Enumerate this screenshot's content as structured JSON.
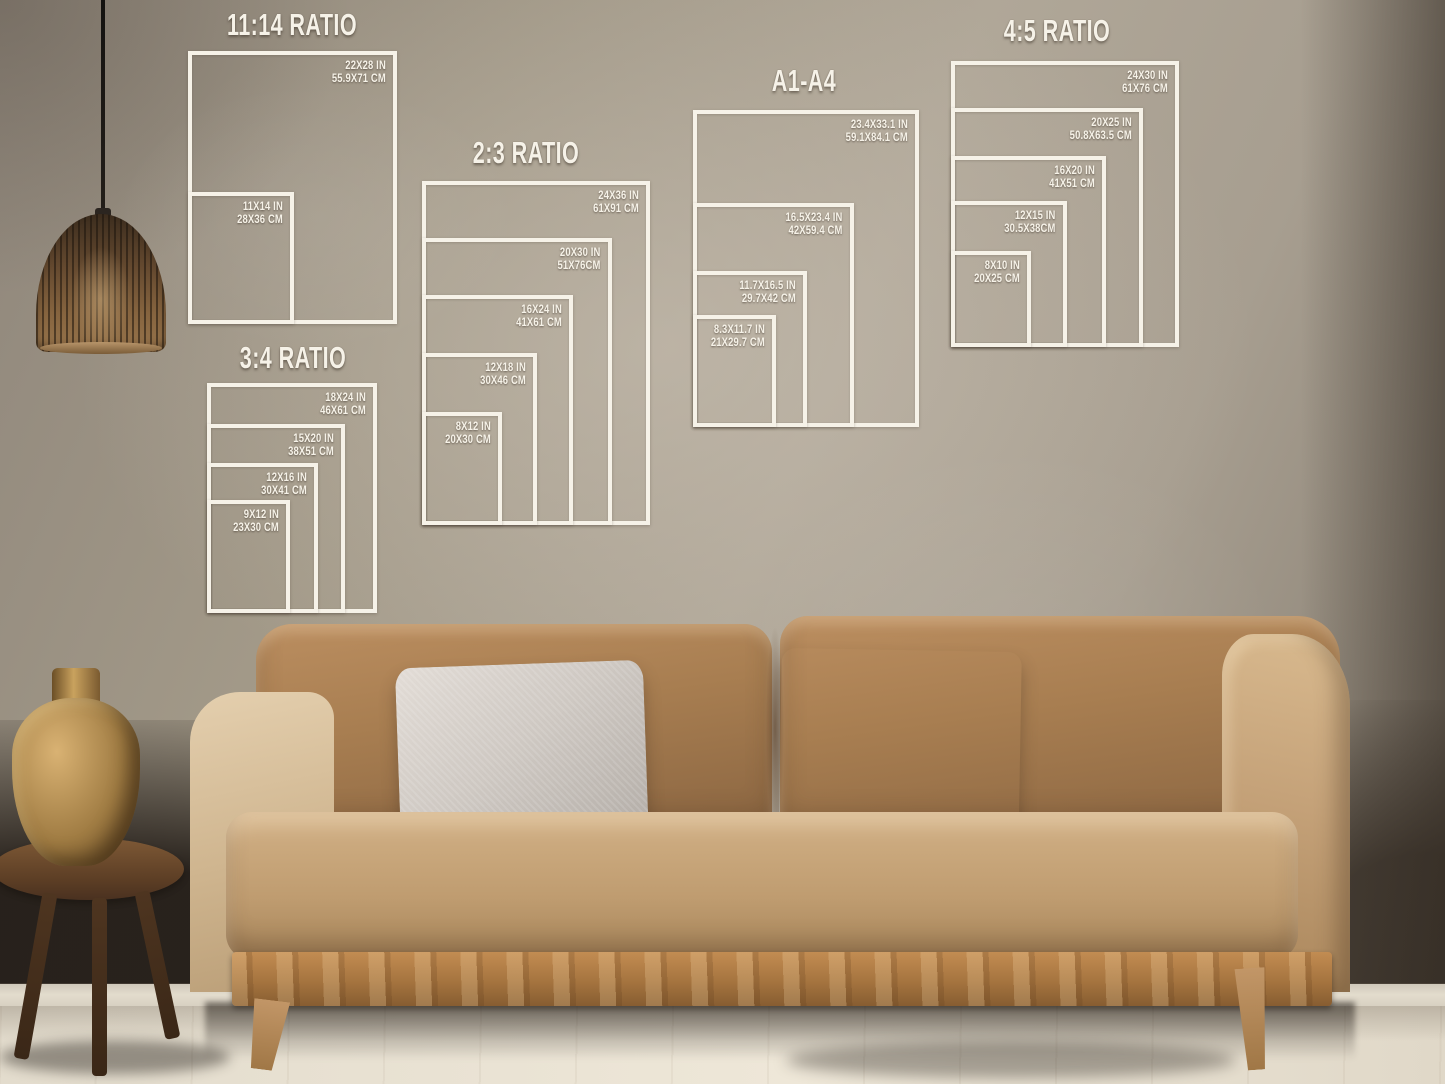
{
  "scene": {
    "overlay_line_color": "#f6f2e8",
    "wall_color": "#a89e91",
    "sofa_color": "#b4895c",
    "floor_color": "#e6dfd1",
    "pillow_colors": [
      "#cfc9c3",
      "#685d57",
      "#999575"
    ]
  },
  "panels": [
    {
      "title": "11:14 RATIO",
      "sizes": [
        {
          "in": "22X28 IN",
          "cm": "55.9X71 CM"
        },
        {
          "in": "11X14 IN",
          "cm": "28X36 CM"
        }
      ]
    },
    {
      "title": "2:3 RATIO",
      "sizes": [
        {
          "in": "24X36 IN",
          "cm": "61X91 CM"
        },
        {
          "in": "20X30 IN",
          "cm": "51X76CM"
        },
        {
          "in": "16X24 IN",
          "cm": "41X61 CM"
        },
        {
          "in": "12X18 IN",
          "cm": "30X46 CM"
        },
        {
          "in": "8X12 IN",
          "cm": "20X30 CM"
        }
      ]
    },
    {
      "title": "3:4 RATIO",
      "sizes": [
        {
          "in": "18X24 IN",
          "cm": "46X61 CM"
        },
        {
          "in": "15X20 IN",
          "cm": "38X51 CM"
        },
        {
          "in": "12X16 IN",
          "cm": "30X41 CM"
        },
        {
          "in": "9X12 IN",
          "cm": "23X30 CM"
        }
      ]
    },
    {
      "title": "A1-A4",
      "sizes": [
        {
          "in": "23.4X33.1 IN",
          "cm": "59.1X84.1 CM"
        },
        {
          "in": "16.5X23.4 IN",
          "cm": "42X59.4 CM"
        },
        {
          "in": "11.7X16.5 IN",
          "cm": "29.7X42 CM"
        },
        {
          "in": "8.3X11.7 IN",
          "cm": "21X29.7 CM"
        }
      ]
    },
    {
      "title": "4:5 RATIO",
      "sizes": [
        {
          "in": "24X30 IN",
          "cm": "61X76 CM"
        },
        {
          "in": "20X25 IN",
          "cm": "50.8X63.5 CM"
        },
        {
          "in": "16X20 IN",
          "cm": "41X51 CM"
        },
        {
          "in": "12X15 IN",
          "cm": "30.5X38CM"
        },
        {
          "in": "8X10 IN",
          "cm": "20X25 CM"
        }
      ]
    }
  ]
}
